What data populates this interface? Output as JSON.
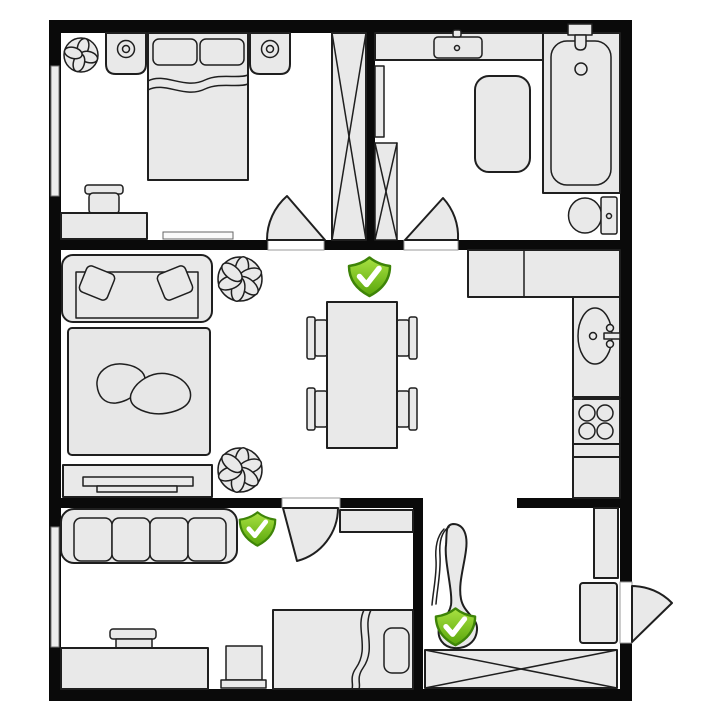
{
  "floorplan": {
    "title": "apartment-floor-plan",
    "colors": {
      "background": "#ffffff",
      "wall": "#0a0a0a",
      "furniture_fill": "#e9e9e9",
      "furniture_stroke": "#1f1f1f",
      "rug_fill": "#e7e7e7",
      "window_fill": "#ededed",
      "badge_green_light": "#a9e242",
      "badge_green_dark": "#58a50a",
      "badge_border": "#3e8408",
      "check_color": "#ffffff"
    },
    "checkmarks": [
      {
        "icon": "shield-check-icon",
        "status": "placed",
        "location": "hallway-above-dining-table",
        "x": 347,
        "y": 256,
        "size": 45
      },
      {
        "icon": "shield-check-icon",
        "status": "placed",
        "location": "second-room-right-of-sofa",
        "x": 238,
        "y": 511,
        "size": 39
      },
      {
        "icon": "shield-check-icon",
        "status": "placed",
        "location": "entry-on-lounge-chair",
        "x": 434,
        "y": 607,
        "size": 43
      }
    ],
    "rooms": [
      {
        "name": "bedroom",
        "position": "top-left",
        "furniture": [
          "potted-plant",
          "nightstand-with-lamp",
          "double-bed",
          "nightstand-with-lamp",
          "wardrobe",
          "desk",
          "desk-chair",
          "wall-bench",
          "door",
          "window"
        ]
      },
      {
        "name": "bathroom",
        "position": "top-right",
        "furniture": [
          "counter-with-sink",
          "bathtub",
          "bath-mat",
          "toilet",
          "cabinet",
          "shelf",
          "door"
        ]
      },
      {
        "name": "living-room",
        "position": "middle-left",
        "furniture": [
          "sofa",
          "potted-plant",
          "rug",
          "potted-plant",
          "tv-stand"
        ]
      },
      {
        "name": "dining-area",
        "position": "middle-center",
        "furniture": [
          "dining-table",
          "chair",
          "chair",
          "chair",
          "chair"
        ]
      },
      {
        "name": "kitchen",
        "position": "middle-right",
        "furniture": [
          "counter",
          "sink",
          "stove",
          "counter"
        ]
      },
      {
        "name": "second-room",
        "position": "bottom-left",
        "furniture": [
          "sofa",
          "wall-shelf",
          "desk",
          "desk-chair",
          "stool",
          "single-bed",
          "door",
          "window"
        ]
      },
      {
        "name": "entry",
        "position": "bottom-right",
        "furniture": [
          "lounge-chair",
          "counter",
          "doormat",
          "wardrobe",
          "entrance-door"
        ]
      }
    ]
  }
}
